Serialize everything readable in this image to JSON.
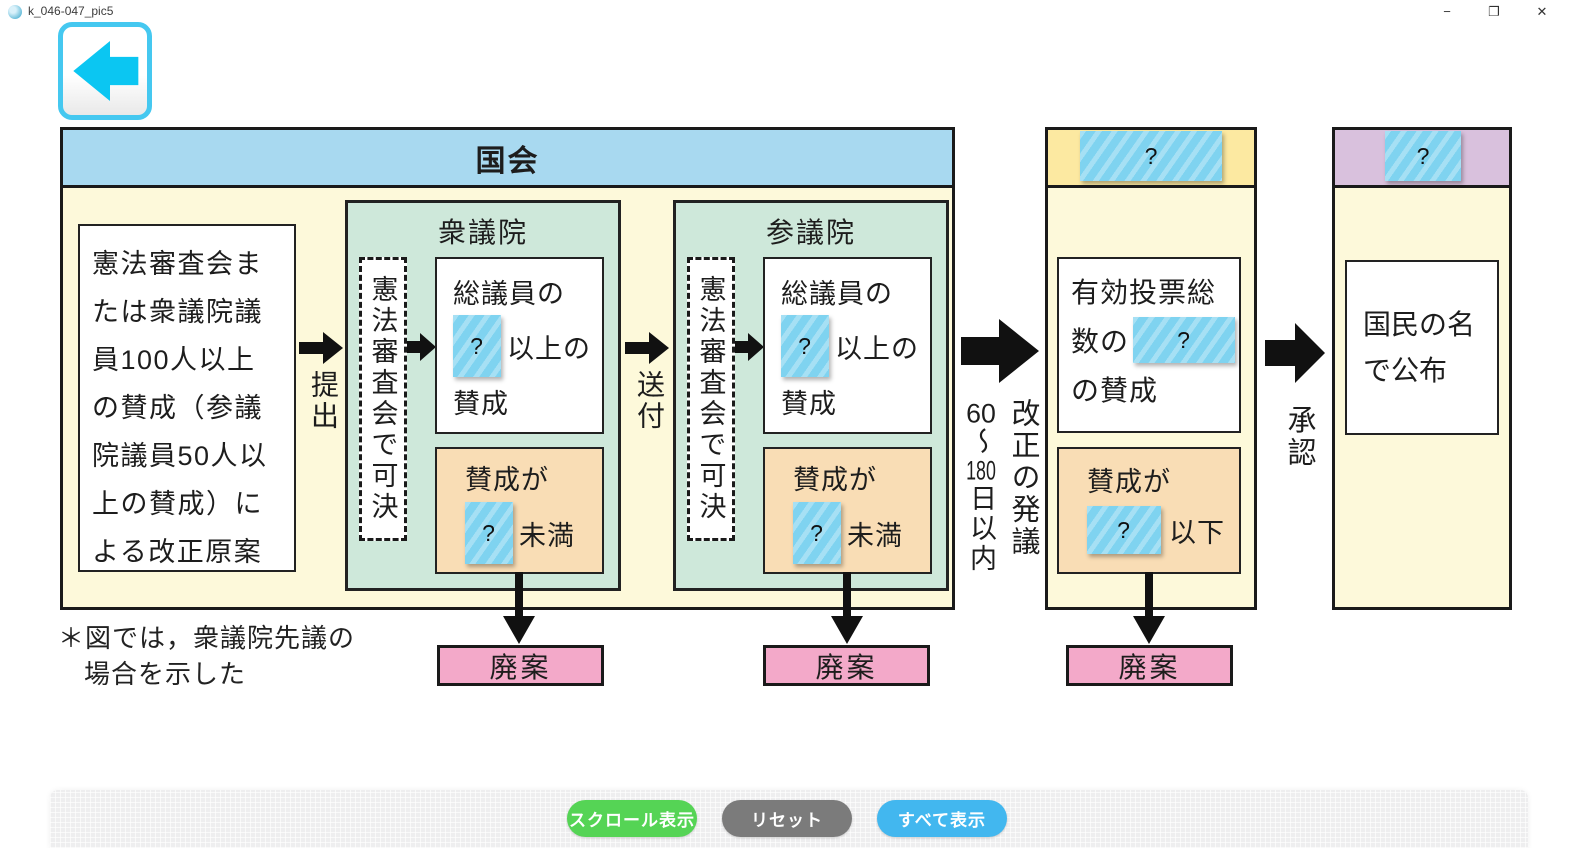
{
  "window": {
    "title": "k_046-047_pic5",
    "minimize_glyph": "−",
    "restore_glyph": "❐",
    "close_glyph": "✕"
  },
  "colors": {
    "diet_header_blue": "#a8d9f0",
    "body_pale_yellow": "#fdf9da",
    "house_green": "#cee8da",
    "fail_orange": "#f9ddb5",
    "discard_pink": "#f3a9c9",
    "referendum_header_yellow": "#fce9a1",
    "promulgation_header_purple": "#d9c1dd",
    "sticker_blue": "#7fd3f0",
    "back_button_cyan": "#45c8f0",
    "button_green": "#55d455",
    "button_gray": "#7b7b7b",
    "button_blue": "#42b7ef"
  },
  "diagram": {
    "q": "?",
    "diet_title": "国会",
    "proposal_text": "憲法審査会または衆議院議員100人以上の賛成（参議院議員50人以上の賛成）による改正原案",
    "submit_label": "提出",
    "send_label": "送付",
    "houses": [
      {
        "name": "衆議院",
        "committee": "憲法審査会で可決",
        "vote_l1": "総議員の",
        "vote_l2": "以上の",
        "vote_l3": "賛成",
        "fail_l1": "賛成が",
        "fail_l2": "未満",
        "discard": "廃案"
      },
      {
        "name": "参議院",
        "committee": "憲法審査会で可決",
        "vote_l1": "総議員の",
        "vote_l2": "以上の",
        "vote_l3": "賛成",
        "fail_l1": "賛成が",
        "fail_l2": "未満",
        "discard": "廃案"
      }
    ],
    "initiate_label": "改正の発議",
    "days": {
      "n1": "60",
      "tilde": "〜",
      "n2": "180",
      "rest": "日以内"
    },
    "referendum": {
      "body_l1": "有効投票総",
      "body_l2": "数の",
      "body_l3": "の賛成",
      "fail_l1": "賛成が",
      "fail_l2": "以下",
      "discard": "廃案"
    },
    "approval_label": "承認",
    "promulgation": {
      "text_l1": "国民の名",
      "text_l2": "で公布"
    },
    "note_line1": "＊図では，衆議院先議の",
    "note_line2": "場合を示した"
  },
  "toolbar": {
    "buttons": [
      {
        "label": "スクロール表示"
      },
      {
        "label": "リセット"
      },
      {
        "label": "すべて表示"
      }
    ]
  }
}
